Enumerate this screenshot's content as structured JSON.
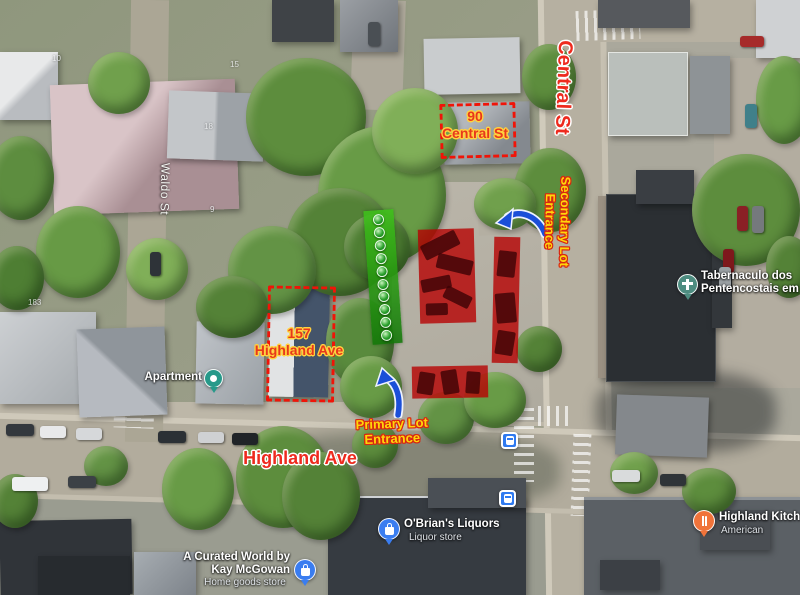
{
  "streets": {
    "central": "Central St",
    "highland": "Highland Ave",
    "waldo": "Waldo St"
  },
  "callouts": [
    {
      "line1": "90",
      "line2": "Central St"
    },
    {
      "line1": "157",
      "line2": "Highland Ave"
    }
  ],
  "entrances": [
    {
      "line1": "Secondary Lot",
      "line2": "Entrance"
    },
    {
      "line1": "Primary Lot",
      "line2": "Entrance"
    }
  ],
  "pois": [
    {
      "name": "Tabernaculo dos Pentencostais em",
      "category": "",
      "icon": "church-pin",
      "color": "#4d8c80"
    },
    {
      "name": "Apartment",
      "category": "",
      "icon": "lodging-pin",
      "color": "#27998a"
    },
    {
      "name": "O'Brian's Liquors",
      "category": "Liquor store",
      "icon": "shopping-pin",
      "color": "#3a7df0"
    },
    {
      "name": "A Curated World by Kay McGowan",
      "category": "Home goods store",
      "icon": "shopping-pin",
      "color": "#3a7df0"
    },
    {
      "name": "Highland Kitchen",
      "category": "American",
      "icon": "restaurant-pin",
      "color": "#f0733a"
    }
  ],
  "house_numbers": [
    "10",
    "15",
    "18",
    "9",
    "183"
  ],
  "markers": {
    "green_spots": 10,
    "bus_stops": 2
  },
  "colors": {
    "annotation_red": "#ee2a1e",
    "callout_red": "#e8381c",
    "callout_outline_yellow": "#ffd23f",
    "entrance_yellow": "#ffd60a",
    "entrance_outline_red": "#d92712",
    "zone_red": "rgba(183,2,2,0.8)",
    "zone_green": "#2fae12",
    "arrow_blue": "#1b4fd8",
    "dashed_red": "#f01408"
  }
}
